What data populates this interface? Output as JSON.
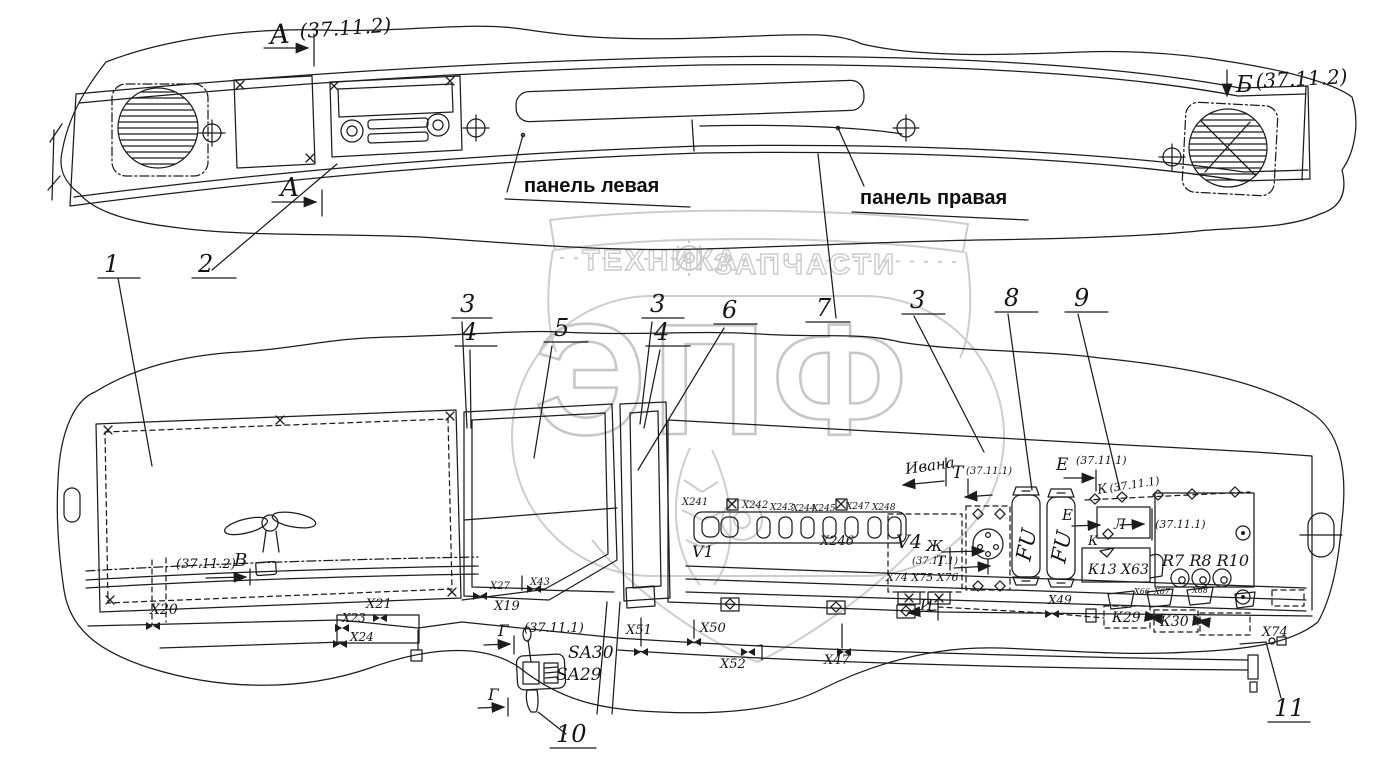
{
  "page": {
    "background": "#ffffff",
    "ink_color": "#1c1c1c",
    "watermark_color": "#cdcdcd"
  },
  "watermark": {
    "brand": "ЭПФ",
    "tag_left": "ТЕХНИКА",
    "tag_right": "ЗАПЧАСТИ"
  },
  "top_view": {
    "section_a_letter": "А",
    "section_a_ref": "(37.11.2)",
    "section_b_letter": "Б",
    "section_b_ref": "(37.11.2)",
    "panel_left_label": "панель левая",
    "panel_right_label": "панель правая"
  },
  "callouts": {
    "c1": "1",
    "c2": "2",
    "c3": "3",
    "c4": "4",
    "c5": "5",
    "c6": "6",
    "c7": "7",
    "c8": "8",
    "c9": "9",
    "c10": "10",
    "c11": "11"
  },
  "bottom_view": {
    "sections": {
      "v_ref": "(37.11.2)",
      "v_letter": "В",
      "g_letter": "Г",
      "g_ref": "(37.11.1)",
      "t_letter": "Т",
      "t_ref": "(37.11.1)",
      "e_letter": "Е",
      "e_ref": "(37.11.1)",
      "k_letter": "К",
      "k_ref": "(37.11.1)",
      "l_letter": "Л",
      "l_ref": "(37.11.1)",
      "zh_letter": "Ж",
      "zh_ref": "(37.11.1)",
      "i_letter": "И",
      "note": "Ивана"
    },
    "components": {
      "v1": "V1",
      "v4": "V4",
      "fu": "FU",
      "k13_x63": "К13 Х63",
      "r_row": "R7 R8 R10",
      "k29": "К29",
      "k30": "К30",
      "x44": "Х44",
      "sa30": "SA30",
      "sa29": "SA29"
    },
    "connectors": {
      "x241": "Х241",
      "x242": "Х242",
      "x243": "Х243",
      "x244": "Х244",
      "x245": "Х245",
      "x246": "Х246",
      "x247": "Х247",
      "x248": "Х248",
      "x74_75_76": "Х74 Х75 Х76",
      "x19": "Х19",
      "x20": "Х20",
      "x21": "Х21",
      "x23": "Х23",
      "x24": "Х24",
      "x27": "Х27",
      "x43": "Х43",
      "x47": "Х47",
      "x49": "Х49",
      "x50": "Х50",
      "x51": "Х51",
      "x52": "Х52",
      "x66": "Х66",
      "x67": "Х67",
      "x68": "Х68",
      "x74": "Х74"
    }
  }
}
